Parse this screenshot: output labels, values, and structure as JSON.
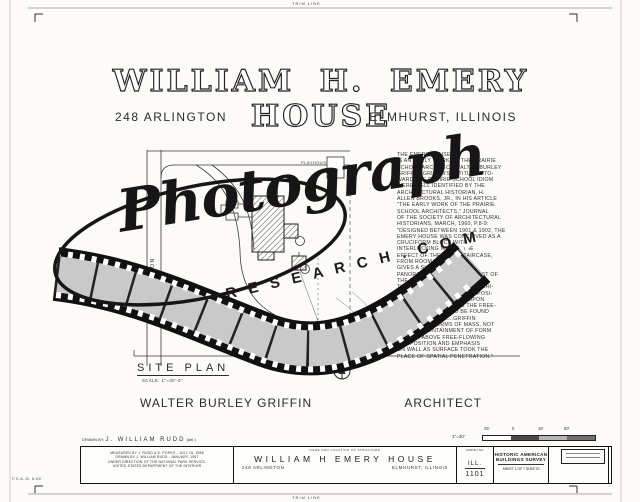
{
  "sheet": {
    "trim_label_top": "TRIM LINE",
    "trim_label_bottom": "TRIM LINE",
    "print_code": "F.S.A.-B. 6-66",
    "title": "WILLIAM H. EMERY HOUSE",
    "address_left": "248 ARLINGTON",
    "address_right": "ELMHURST, ILLINOIS"
  },
  "site_plan": {
    "label": "SITE PLAN",
    "scale_note": "SCALE: 1\"=30'-0\"",
    "street_label": "ARLINGTON",
    "playhouse_label": "PLAYHOUSE"
  },
  "description": {
    "lines": [
      "THE EMERY HOUSE",
      "IS AN EARLY WORK OF THE PRAIRIE",
      "SCHOOL ARCHITECT WALTER BURLEY",
      "GRIFFIN. GRIFFIN'S ATTITUDES TO-",
      "WARD THE PRAIRIE SCHOOL IDIOM",
      "WERE WELL IDENTIFIED BY THE",
      "ARCHITECTURAL HISTORIAN, H.",
      "ALLEN BROOKS, JR., IN HIS ARTICLE",
      "\"THE EARLY WORK OF THE PRAIRIE",
      "SCHOOL ARCHITECTS,\" JOURNAL",
      "OF THE SOCIETY OF ARCHITECTURAL",
      "HISTORIANS, MARCH, 1960, P.8-9:",
      "\"DESIGNED BETWEEN 1901 & 1902, THE",
      "EMERY HOUSE WAS CONCEIVED AS A",
      "CRUCIFORM BLOCK WITH",
      "INTERLOCKING WINGS, THE",
      "EFFECT OF THE OPEN STAIRCASE,",
      "FROM ROOM TO ROOM",
      "GIVES A SUDDEN",
      "PANORAMIC VIEW ACROSS MOST OF",
      "THE HOUSE AS ONE MOUNTS TO",
      "THE UPPER LEVELS....THE EXTERI-",
      "OR IS MORE FORMAL IN COMPOSI-",
      "TION AND THE EMPHASIS UPON",
      "THE RECTANGLE BELIES THE FREE-",
      "DOM OF PLANNING TO BE FOUND",
      "ON THE INTERIOR....GRIFFIN",
      "THOUGHT IN TERMS OF MASS, NOT",
      "VOLUME. CONTAINMENT OF FORM",
      "RANKED ABOVE FREE-FLOWING",
      "COMPOSITION AND EMPHASIS",
      "ON WALL AS SURFACE TOOK THE",
      "PLACE OF SPATIAL PENETRATION.\""
    ]
  },
  "attribution": {
    "architect_name": "WALTER BURLEY GRIFFIN",
    "architect_title": "ARCHITECT"
  },
  "title_block": {
    "drawn_by_label": "DRAWN BY:",
    "drawn_by_name": "J. WILLIAM RUDD",
    "drawn_by_suffix": "(del.)",
    "credits_lines": [
      "MEASURED BY J. RUDD & E. POPKO - JULY 15, 1966",
      "DRAWN BY J. WILLIAM RUDD - JANUARY, 1967",
      "UNDER DIRECTION OF THE NATIONAL PARK SERVICE,",
      "UNITED STATES DEPARTMENT OF THE INTERIOR"
    ],
    "name_location_header": "NAME AND LOCATION OF STRUCTURE",
    "structure_name": "WILLIAM H EMERY HOUSE",
    "structure_address": "248 ARLINGTON",
    "structure_city": "ELMHURST, ILLINOIS",
    "scale_label": "1\"=30'",
    "scale_ticks": [
      "25'",
      "0",
      "15'",
      "50'"
    ],
    "survey_header": "SURVEY NO.",
    "survey_state": "ILL.",
    "survey_number": "1101",
    "habs_line1": "HISTORIC AMERICAN",
    "habs_line2": "BUILDINGS SURVEY",
    "habs_sheet": "SHEET 1 OF 7 SHEETS"
  },
  "watermark": {
    "script_text": "Photograph",
    "domain_text": "R E S E A R C H . C O M"
  },
  "colors": {
    "line": "#2a2a2a",
    "film_frame": "#c9c9c9",
    "paper": "#fcfbf8"
  }
}
